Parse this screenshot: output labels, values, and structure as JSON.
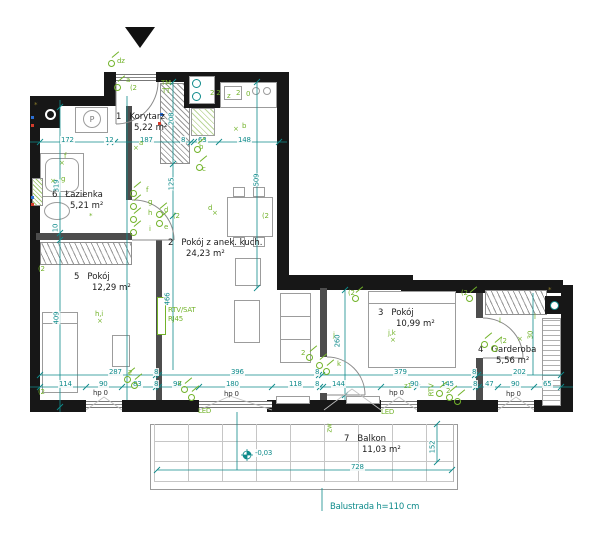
{
  "plan": {
    "colors": {
      "wall": "#171717",
      "dimension": "#0f8b8b",
      "electrical": "#72b32a",
      "interior_wall": "#4d4d4d"
    },
    "rooms": [
      {
        "number": "1",
        "name": "Korytarz",
        "area": "5,22 m²",
        "x": 116,
        "y": 112
      },
      {
        "number": "2",
        "name": "Pokój z anek. kuch.",
        "area": "24,23 m²",
        "x": 168,
        "y": 238
      },
      {
        "number": "3",
        "name": "Pokój",
        "area": "10,99 m²",
        "x": 378,
        "y": 308
      },
      {
        "number": "4",
        "name": "Garderoba",
        "area": "5,56 m²",
        "x": 478,
        "y": 345
      },
      {
        "number": "5",
        "name": "Pokój",
        "area": "12,29 m²",
        "x": 74,
        "y": 272
      },
      {
        "number": "6",
        "name": "Łazienka",
        "area": "5,21 m²",
        "x": 52,
        "y": 190
      },
      {
        "number": "7",
        "name": "Balkon",
        "area": "11,03 m²",
        "x": 344,
        "y": 434
      }
    ],
    "labels": [
      {
        "t": "172",
        "x": 60,
        "y": 136,
        "c": "dim"
      },
      {
        "t": "12",
        "x": 104,
        "y": 136,
        "c": "dim"
      },
      {
        "t": "187",
        "x": 139,
        "y": 136,
        "c": "dim"
      },
      {
        "t": "8",
        "x": 180,
        "y": 136,
        "c": "dim"
      },
      {
        "t": "63",
        "x": 197,
        "y": 136,
        "c": "dim"
      },
      {
        "t": "148",
        "x": 237,
        "y": 136,
        "c": "dim"
      },
      {
        "t": "287",
        "x": 108,
        "y": 368,
        "c": "dim"
      },
      {
        "t": "8",
        "x": 153,
        "y": 368,
        "c": "dim"
      },
      {
        "t": "396",
        "x": 230,
        "y": 368,
        "c": "dim"
      },
      {
        "t": "8",
        "x": 314,
        "y": 368,
        "c": "dim"
      },
      {
        "t": "379",
        "x": 393,
        "y": 368,
        "c": "dim"
      },
      {
        "t": "8",
        "x": 471,
        "y": 368,
        "c": "dim"
      },
      {
        "t": "202",
        "x": 512,
        "y": 368,
        "c": "dim"
      },
      {
        "t": "114",
        "x": 58,
        "y": 380,
        "c": "dim"
      },
      {
        "t": "90",
        "x": 98,
        "y": 380,
        "c": "dim"
      },
      {
        "t": "83",
        "x": 132,
        "y": 380,
        "c": "dim"
      },
      {
        "t": "8",
        "x": 153,
        "y": 380,
        "c": "dim"
      },
      {
        "t": "98",
        "x": 172,
        "y": 380,
        "c": "dim"
      },
      {
        "t": "180",
        "x": 225,
        "y": 380,
        "c": "dim"
      },
      {
        "t": "118",
        "x": 288,
        "y": 380,
        "c": "dim"
      },
      {
        "t": "8",
        "x": 314,
        "y": 380,
        "c": "dim"
      },
      {
        "t": "144",
        "x": 331,
        "y": 380,
        "c": "dim"
      },
      {
        "t": "90",
        "x": 409,
        "y": 380,
        "c": "dim"
      },
      {
        "t": "145",
        "x": 440,
        "y": 380,
        "c": "dim"
      },
      {
        "t": "8",
        "x": 472,
        "y": 380,
        "c": "dim"
      },
      {
        "t": "47",
        "x": 484,
        "y": 380,
        "c": "dim"
      },
      {
        "t": "90",
        "x": 510,
        "y": 380,
        "c": "dim"
      },
      {
        "t": "65",
        "x": 542,
        "y": 380,
        "c": "dim"
      },
      {
        "t": "319",
        "x": 50,
        "y": 182,
        "c": "dimv"
      },
      {
        "t": "10",
        "x": 51,
        "y": 224,
        "c": "dimv"
      },
      {
        "t": "409",
        "x": 50,
        "y": 314,
        "c": "dimv"
      },
      {
        "t": "208",
        "x": 165,
        "y": 115,
        "c": "dimv"
      },
      {
        "t": "125",
        "x": 165,
        "y": 180,
        "c": "dimv"
      },
      {
        "t": "466",
        "x": 161,
        "y": 295,
        "c": "dimv"
      },
      {
        "t": "509",
        "x": 250,
        "y": 176,
        "c": "dimv"
      },
      {
        "t": "260",
        "x": 331,
        "y": 337,
        "c": "dimv"
      },
      {
        "t": "152",
        "x": 426,
        "y": 443,
        "c": "dimv"
      },
      {
        "t": "728",
        "x": 350,
        "y": 463,
        "c": "dim"
      },
      {
        "t": "-0,03",
        "x": 254,
        "y": 449,
        "c": "dim"
      },
      {
        "t": "Balustrada h=110 cm",
        "x": 330,
        "y": 503,
        "c": "note"
      },
      {
        "t": "hp 0",
        "x": 93,
        "y": 389,
        "c": "black"
      },
      {
        "t": "hp 0",
        "x": 224,
        "y": 390,
        "c": "black"
      },
      {
        "t": "hp 0",
        "x": 389,
        "y": 389,
        "c": "black"
      },
      {
        "t": "hp 0",
        "x": 506,
        "y": 390,
        "c": "black"
      },
      {
        "t": "dz",
        "x": 117,
        "y": 57,
        "c": "elec"
      },
      {
        "t": "a",
        "x": 126,
        "y": 76,
        "c": "elec"
      },
      {
        "t": "(2",
        "x": 130,
        "y": 84,
        "c": "elec"
      },
      {
        "t": "TM",
        "x": 161,
        "y": 79,
        "c": "elec"
      },
      {
        "t": "TT",
        "x": 162,
        "y": 87,
        "c": "elec"
      },
      {
        "t": "2 2",
        "x": 210,
        "y": 89,
        "c": "elec"
      },
      {
        "t": "z",
        "x": 227,
        "y": 92,
        "c": "elec"
      },
      {
        "t": "2",
        "x": 236,
        "y": 89,
        "c": "elec"
      },
      {
        "t": "0",
        "x": 246,
        "y": 90,
        "c": "elec"
      },
      {
        "t": "a",
        "x": 139,
        "y": 139,
        "c": "elec"
      },
      {
        "t": "×",
        "x": 133,
        "y": 144,
        "c": "elec"
      },
      {
        "t": "b",
        "x": 242,
        "y": 122,
        "c": "elec"
      },
      {
        "t": "×",
        "x": 233,
        "y": 125,
        "c": "elec"
      },
      {
        "t": "b",
        "x": 199,
        "y": 143,
        "c": "elec"
      },
      {
        "t": "c",
        "x": 202,
        "y": 165,
        "c": "elec"
      },
      {
        "t": "d",
        "x": 164,
        "y": 206,
        "c": "elec"
      },
      {
        "t": "e",
        "x": 164,
        "y": 223,
        "c": "elec"
      },
      {
        "t": "(2",
        "x": 173,
        "y": 212,
        "c": "elec"
      },
      {
        "t": "d",
        "x": 208,
        "y": 204,
        "c": "elec"
      },
      {
        "t": "×",
        "x": 212,
        "y": 209,
        "c": "elec"
      },
      {
        "t": "(2",
        "x": 262,
        "y": 212,
        "c": "elec"
      },
      {
        "t": "f",
        "x": 146,
        "y": 186,
        "c": "elec"
      },
      {
        "t": "g",
        "x": 148,
        "y": 198,
        "c": "elec"
      },
      {
        "t": "h",
        "x": 148,
        "y": 209,
        "c": "elec"
      },
      {
        "t": "i",
        "x": 149,
        "y": 225,
        "c": "elec"
      },
      {
        "t": "f",
        "x": 64,
        "y": 152,
        "c": "elec"
      },
      {
        "t": "×",
        "x": 59,
        "y": 159,
        "c": "elec"
      },
      {
        "t": "g",
        "x": 61,
        "y": 175,
        "c": "elec"
      },
      {
        "t": "×",
        "x": 50,
        "y": 177,
        "c": "elec"
      },
      {
        "t": "*",
        "x": 89,
        "y": 212,
        "c": "elec"
      },
      {
        "t": "h,i",
        "x": 95,
        "y": 310,
        "c": "elec"
      },
      {
        "t": "×",
        "x": 97,
        "y": 317,
        "c": "elec"
      },
      {
        "t": "(2",
        "x": 38,
        "y": 265,
        "c": "elec"
      },
      {
        "t": "(2",
        "x": 38,
        "y": 388,
        "c": "elec"
      },
      {
        "t": "RTV/SAT",
        "x": 168,
        "y": 306,
        "c": "elec"
      },
      {
        "t": "RJ45",
        "x": 168,
        "y": 315,
        "c": "elec"
      },
      {
        "t": "2",
        "x": 301,
        "y": 349,
        "c": "elec"
      },
      {
        "t": "j",
        "x": 333,
        "y": 331,
        "c": "elec"
      },
      {
        "t": "k",
        "x": 337,
        "y": 360,
        "c": "elec"
      },
      {
        "t": "(2",
        "x": 348,
        "y": 289,
        "c": "elec"
      },
      {
        "t": "(2",
        "x": 461,
        "y": 289,
        "c": "elec"
      },
      {
        "t": "j,k",
        "x": 388,
        "y": 329,
        "c": "elec"
      },
      {
        "t": "×",
        "x": 390,
        "y": 336,
        "c": "elec"
      },
      {
        "t": "l",
        "x": 499,
        "y": 317,
        "c": "elec"
      },
      {
        "t": "(2",
        "x": 500,
        "y": 337,
        "c": "elec"
      },
      {
        "t": "l",
        "x": 534,
        "y": 313,
        "c": "elec"
      },
      {
        "t": "×",
        "x": 517,
        "y": 335,
        "c": "elec"
      },
      {
        "t": "30",
        "x": 526,
        "y": 331,
        "c": "elecv"
      },
      {
        "t": "2",
        "x": 128,
        "y": 369,
        "c": "elec"
      },
      {
        "t": "z",
        "x": 178,
        "y": 379,
        "c": "elec"
      },
      {
        "t": "z1",
        "x": 404,
        "y": 382,
        "c": "elec"
      },
      {
        "t": "2",
        "x": 446,
        "y": 387,
        "c": "elec"
      },
      {
        "t": "RTV",
        "x": 425,
        "y": 386,
        "c": "elecv"
      },
      {
        "t": "zw",
        "x": 325,
        "y": 424,
        "c": "elecv"
      },
      {
        "t": "LED",
        "x": 198,
        "y": 407,
        "c": "elec"
      },
      {
        "t": "LED",
        "x": 381,
        "y": 408,
        "c": "elec"
      },
      {
        "t": "*",
        "x": 34,
        "y": 101,
        "c": "olive"
      },
      {
        "t": "*",
        "x": 548,
        "y": 286,
        "c": "olive"
      },
      {
        "t": "P",
        "x": 0,
        "y": 0,
        "c": "hidden"
      }
    ],
    "glyphs": [
      [
        108,
        60
      ],
      [
        114,
        84
      ],
      [
        130,
        190
      ],
      [
        130,
        203
      ],
      [
        130,
        216
      ],
      [
        130,
        229
      ],
      [
        156,
        211
      ],
      [
        156,
        220
      ],
      [
        194,
        146
      ],
      [
        196,
        164
      ],
      [
        306,
        354
      ],
      [
        316,
        362
      ],
      [
        323,
        368
      ],
      [
        352,
        295
      ],
      [
        466,
        295
      ],
      [
        481,
        341
      ],
      [
        491,
        345
      ],
      [
        124,
        376
      ],
      [
        131,
        382
      ],
      [
        181,
        386
      ],
      [
        188,
        394
      ],
      [
        436,
        390
      ],
      [
        446,
        394
      ],
      [
        454,
        398
      ]
    ],
    "washer_letter": "P"
  }
}
